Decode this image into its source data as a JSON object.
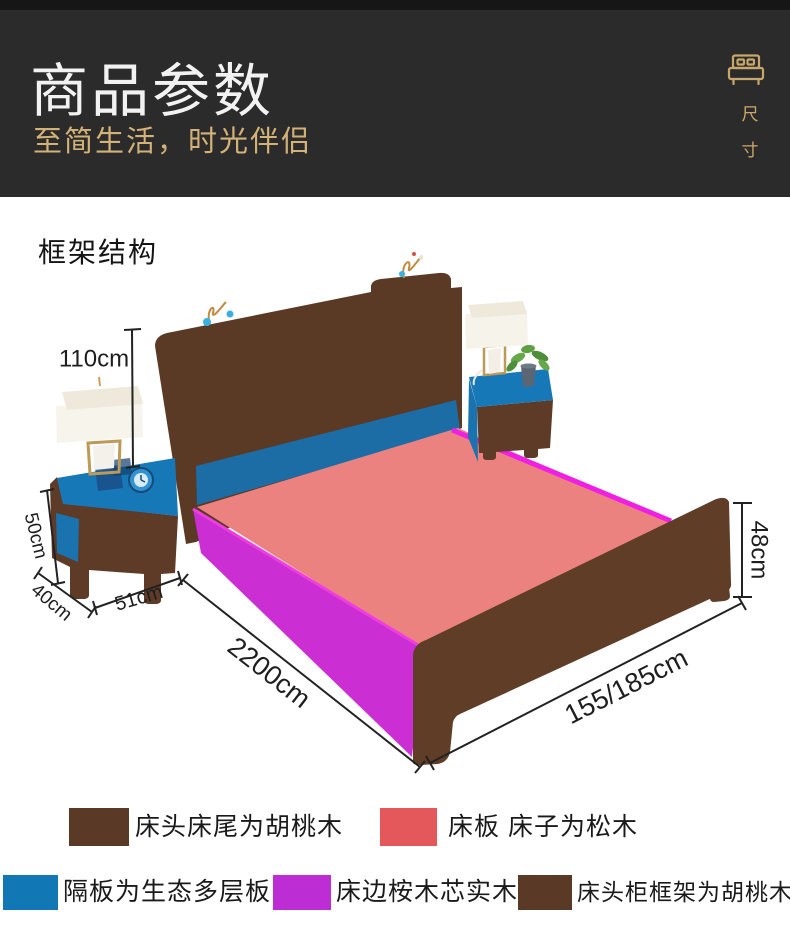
{
  "header": {
    "title": "商品参数",
    "subtitle": "至简生活，时光伴侣",
    "size_chars": [
      "尺",
      "寸"
    ]
  },
  "section": {
    "heading": "框架结构"
  },
  "diagram": {
    "dims": {
      "headboard_height": "110cm",
      "nightstand_height": "50cm",
      "nightstand_depth": "40cm",
      "nightstand_width": "51cm",
      "bed_length": "2200cm",
      "bed_width": "155/185cm",
      "footboard_height": "48cm"
    }
  },
  "legend": {
    "items": [
      {
        "label": "床头床尾为胡桃木",
        "color": "#5a3a26"
      },
      {
        "label": "床板 床子为松木",
        "color": "#e4585c"
      },
      {
        "label": "隔板为生态多层板",
        "color": "#1277b5"
      },
      {
        "label": "床边桉木芯实木",
        "color": "#bc2ed3"
      },
      {
        "label": "床头柜框架为胡桃木",
        "color": "#5a3a26"
      }
    ]
  },
  "palette": {
    "header_bg": "#2b2b2b",
    "accent_gold": "#cda968",
    "walnut_brown": "#5d3b26",
    "pine_salmon": "#ec8280",
    "eco_blue": "#1c6da6",
    "nightstand_top_blue": "#1778b8",
    "rail_magenta": "#cb2ed3",
    "rail_edge_magenta": "#f01fe4"
  }
}
